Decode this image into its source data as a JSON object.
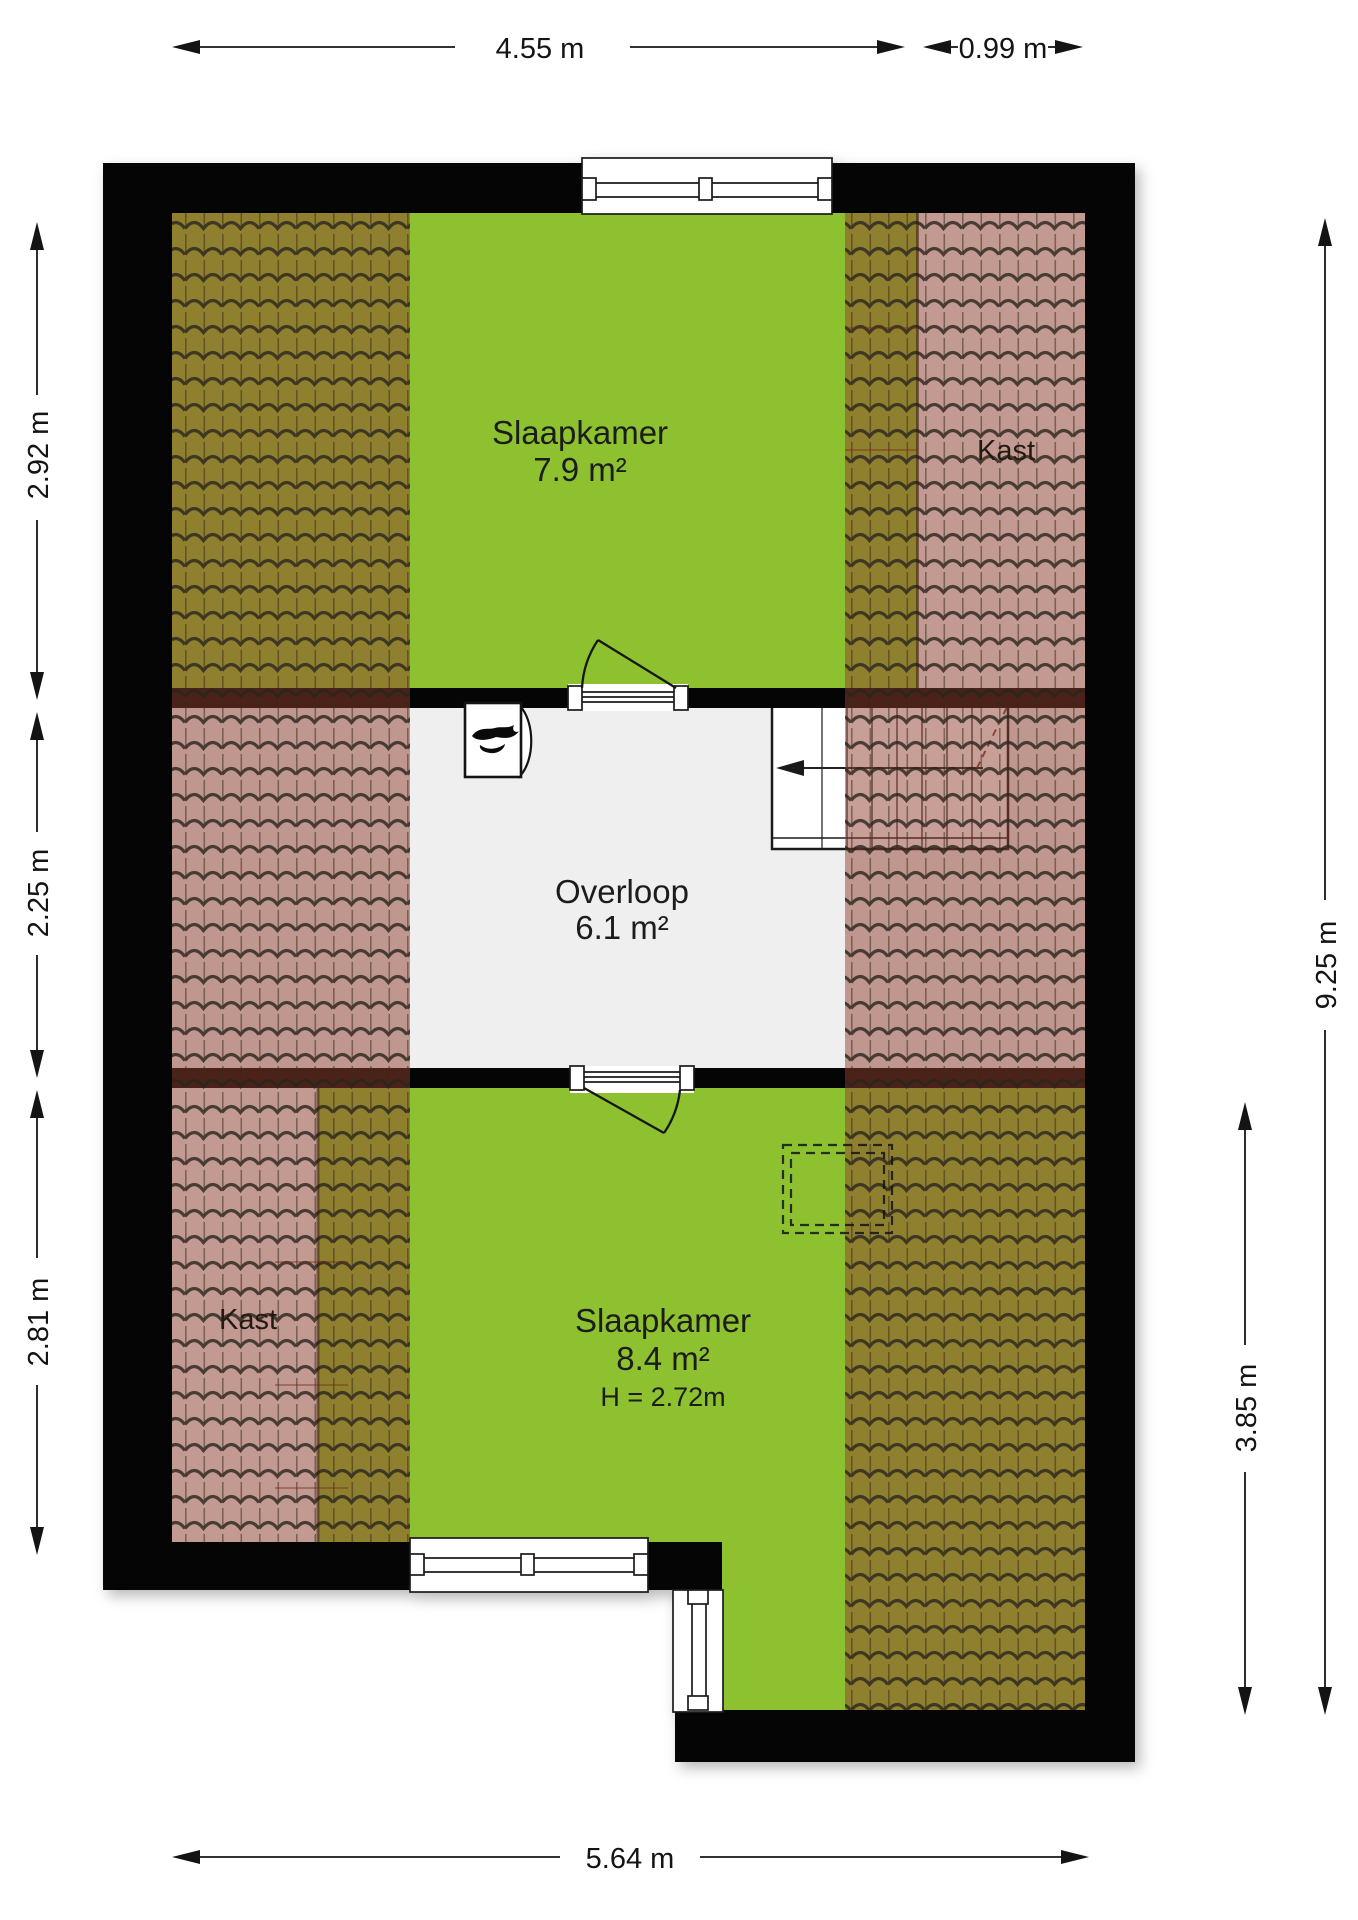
{
  "rooms": {
    "bedroom_top": {
      "label": "Slaapkamer",
      "area": "7.9 m²"
    },
    "landing": {
      "label": "Overloop",
      "area": "6.1 m²"
    },
    "bedroom_bottom": {
      "label": "Slaapkamer",
      "area": "8.4 m²",
      "ceiling_height": "H = 2.72m"
    },
    "closet_top_right": {
      "label": "Kast"
    },
    "closet_bottom_left": {
      "label": "Kast"
    }
  },
  "dimensions": {
    "top_width": "4.55 m",
    "top_right_width": "0.99 m",
    "left_upper": "2.92 m",
    "left_middle": "2.25 m",
    "left_lower": "2.81 m",
    "right_total": "9.25 m",
    "right_lower": "3.85 m",
    "bottom_width": "5.64 m"
  },
  "colors": {
    "room_fill": "#8dc12f",
    "landing_fill": "#efefef",
    "closet_floor": "#f4f4f4",
    "wall_fill": "#050505",
    "roof_tile_overlay": "#8f4030"
  },
  "icons": {
    "stairs_direction": "up-arrow-left",
    "boiler": "flame"
  }
}
